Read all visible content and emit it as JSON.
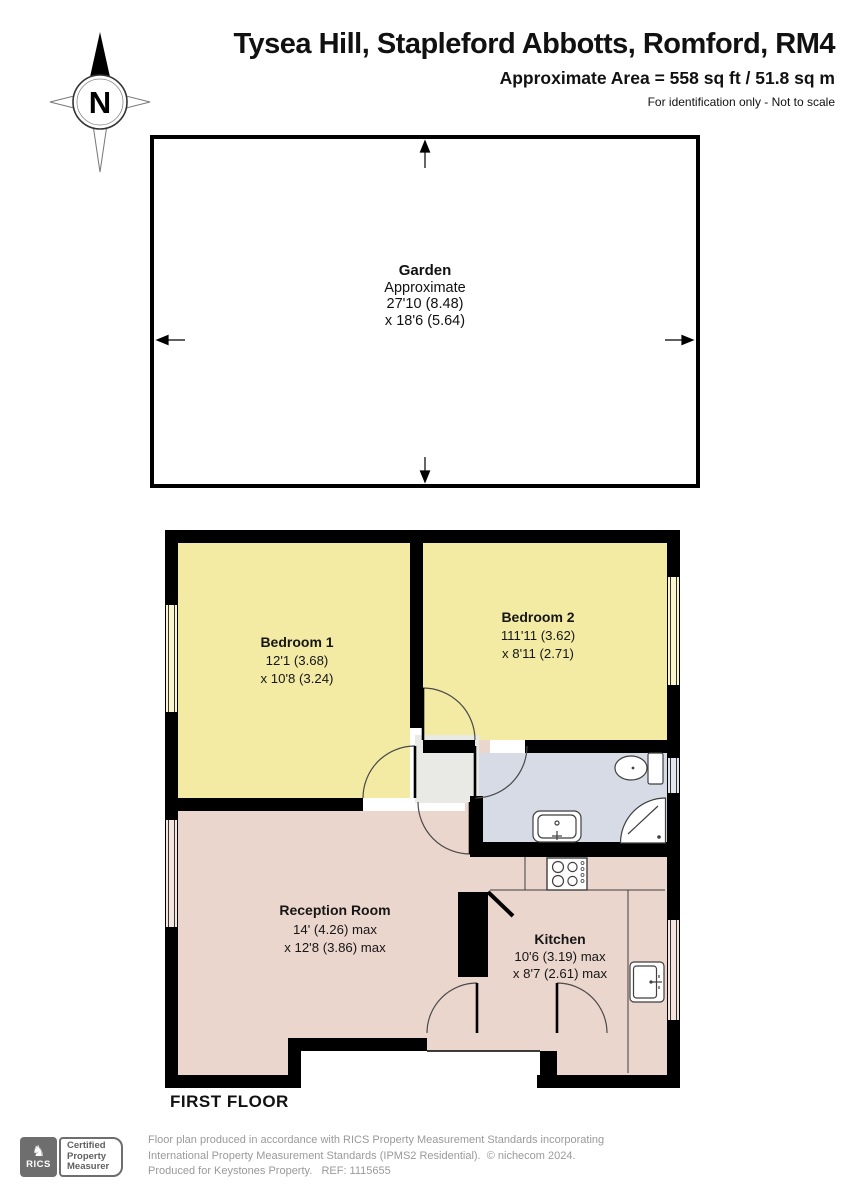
{
  "header": {
    "title": "Tysea Hill, Stapleford Abbotts, Romford, RM4",
    "area_line": "Approximate Area = 558 sq ft / 51.8 sq m",
    "scale_note": "For identification only - Not to scale",
    "compass_label": "N"
  },
  "garden": {
    "name": "Garden",
    "line1": "Approximate",
    "line2": "27'10 (8.48)",
    "line3": "x 18'6 (5.64)"
  },
  "floor": {
    "label": "FIRST FLOOR",
    "rooms": {
      "bedroom1": {
        "name": "Bedroom 1",
        "dim1": "12'1 (3.68)",
        "dim2": "x 10'8 (3.24)"
      },
      "bedroom2": {
        "name": "Bedroom 2",
        "dim1": "111'11 (3.62)",
        "dim2": "x 8'11 (2.71)"
      },
      "reception": {
        "name": "Reception Room",
        "dim1": "14' (4.26) max",
        "dim2": "x 12'8 (3.86) max"
      },
      "kitchen": {
        "name": "Kitchen",
        "dim1": "10'6 (3.19) max",
        "dim2": "x 8'7 (2.61) max"
      }
    }
  },
  "footer": {
    "badge": {
      "org": "RICS",
      "knight_glyph": "♞",
      "line1": "Certified",
      "line2": "Property",
      "line3": "Measurer"
    },
    "note_line1": "Floor plan produced in accordance with RICS Property Measurement Standards incorporating",
    "note_line2": "International Property Measurement Standards (IPMS2 Residential).  © nichecom 2024.",
    "note_line3": "Produced for Keystones Property.   REF: 1115655"
  },
  "colors": {
    "bedroom_fill": "#F3EAA4",
    "living_fill": "#EBD6CD",
    "bath_fill": "#D7DBE6",
    "hall_fill": "#E9E9E6",
    "window_bedroom": "#FAF4CF",
    "window_living": "#F3E5DE",
    "window_bath": "#E3E6EE"
  }
}
